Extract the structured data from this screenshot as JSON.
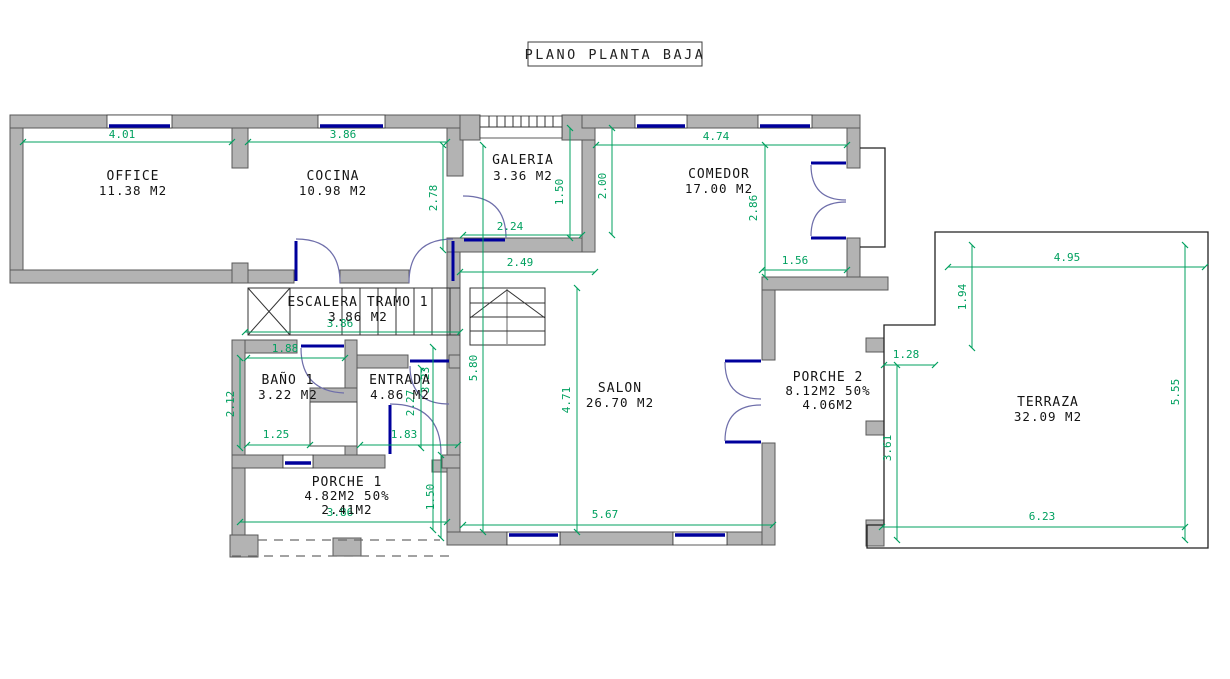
{
  "title": "PLANO PLANTA BAJA",
  "rooms": {
    "office": {
      "name": "OFFICE",
      "area": "11.38 M2"
    },
    "cocina": {
      "name": "COCINA",
      "area": "10.98 M2"
    },
    "galeria": {
      "name": "GALERIA",
      "area": "3.36 M2"
    },
    "comedor": {
      "name": "COMEDOR",
      "area": "17.00 M2"
    },
    "escalera": {
      "name": "ESCALERA TRAMO 1",
      "area": "3.86 M2"
    },
    "bano": {
      "name": "BAÑO 1",
      "area": "3.22 M2"
    },
    "entrada": {
      "name": "ENTRADA",
      "area": "4.86 M2"
    },
    "porche1": {
      "name": "PORCHE 1",
      "area": "4.82M2 50%",
      "area2": "2.41M2"
    },
    "salon": {
      "name": "SALON",
      "area": "26.70 M2"
    },
    "porche2": {
      "name": "PORCHE 2",
      "area": "8.12M2 50%",
      "area2": "4.06M2"
    },
    "terraza": {
      "name": "TERRAZA",
      "area": "32.09 M2"
    }
  },
  "dimensions": {
    "office_width": "4.01",
    "cocina_width": "3.86",
    "comedor_width": "4.74",
    "comedor_left_height": "2.00",
    "cocina_right_height": "2.78",
    "galeria_height": "1.50",
    "galeria_door_width": "2.24",
    "hall_width": "2.49",
    "comedor_right_height": "2.86",
    "comedor_door_width": "1.56",
    "salon_left_height": "5.80",
    "salon_height": "4.71",
    "salon_width": "5.67",
    "escalera_width": "3.86",
    "bano_top_width": "1.88",
    "bano_left_height": "2.12",
    "bano_bottom_width": "1.25",
    "entrada_door_width": "1.83",
    "entrada_height": "2.27",
    "entrada_right_height": "3.23",
    "porche1_height": "1.50",
    "porche1_width": "3.86",
    "porche2_step_width": "1.28",
    "porche2_height": "3.61",
    "terraza_top_width": "4.95",
    "terraza_step_height": "1.94",
    "terraza_right_height": "5.55",
    "terraza_bottom_width": "6.23"
  },
  "colors": {
    "dimension_green": "#00a05f",
    "wall_fill": "#b3b3b3",
    "wall_stroke": "#585858",
    "window_blue": "#00009c",
    "door_arc": "#6e6eaa"
  }
}
